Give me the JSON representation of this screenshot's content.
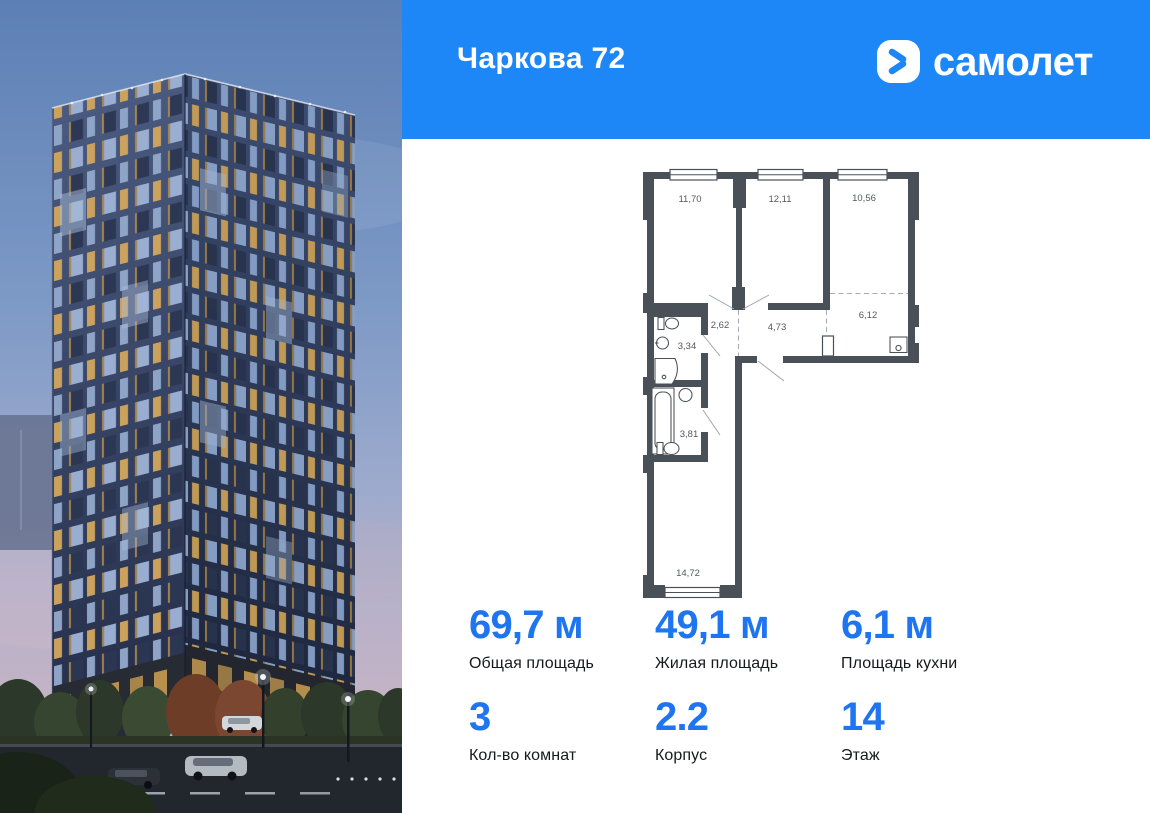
{
  "header": {
    "project_title": "Чаркова 72",
    "brand_name": "самолет",
    "bg_color": "#1e87f8"
  },
  "floor_plan": {
    "area_labels": {
      "room1": "11,70",
      "room2": "12,11",
      "room3": "10,56",
      "hall_small": "2,62",
      "hallway": "4,73",
      "kitchen": "6,12",
      "bathroom_small": "3,34",
      "bathroom_large": "3,81",
      "living_room": "14,72"
    }
  },
  "stats": {
    "rows": [
      {
        "cells": [
          {
            "value": "69,7 м",
            "label": "Общая площадь"
          },
          {
            "value": "49,1 м",
            "label": "Жилая площадь"
          },
          {
            "value": "6,1 м",
            "label": "Площадь кухни"
          }
        ]
      },
      {
        "cells": [
          {
            "value": "3",
            "label": "Кол-во комнат"
          },
          {
            "value": "2.2",
            "label": "Корпус"
          },
          {
            "value": "14",
            "label": "Этаж"
          }
        ]
      }
    ]
  },
  "colors": {
    "header_blue": "#1e87f8",
    "stat_blue": "#1f74f0",
    "plan_wall": "#4a5057"
  }
}
